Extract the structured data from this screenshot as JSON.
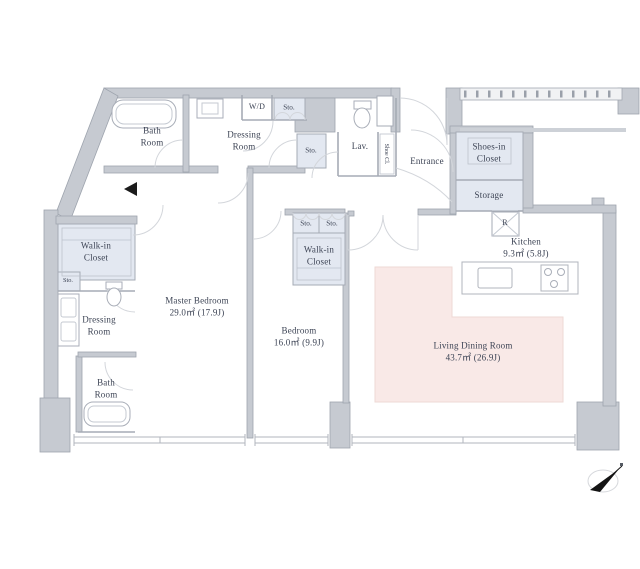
{
  "title": "Apartment floor plan",
  "colors": {
    "wall": "#c6cad1",
    "wall_line": "#9ea4ae",
    "closet_fill": "#e3e8f1",
    "living_fill": "#f9e9e7",
    "text": "#3c4354",
    "north_arrow": "#141414"
  },
  "rooms": {
    "bath_top": "Bath\nRoom",
    "dressing_top": "Dressing\nRoom",
    "wd": "W/D",
    "sto_top": "Sto.",
    "sto_mid": "Sto.",
    "lav": "Lav.",
    "shoe_closet": "Shoe Cl.",
    "entrance": "Entrance",
    "shoes_in_closet": "Shoes-in\nCloset",
    "storage": "Storage",
    "refrigerator": "R",
    "kitchen": "Kitchen\n9.3㎡  (5.8J)",
    "walk_in_closet_left": "Walk-in\nCloset",
    "sto_left": "Sto.",
    "dressing_left": "Dressing\nRoom",
    "bath_bottom": "Bath\nRoom",
    "master_bedroom": "Master Bedroom\n29.0㎡  (17.9J)",
    "bedroom": "Bedroom\n16.0㎡  (9.9J)",
    "sto_a": "Sto.",
    "sto_b": "Sto.",
    "walk_in_closet_center": "Walk-in\nCloset",
    "living_dining": "Living Dining Room\n43.7㎡  (26.9J)"
  }
}
